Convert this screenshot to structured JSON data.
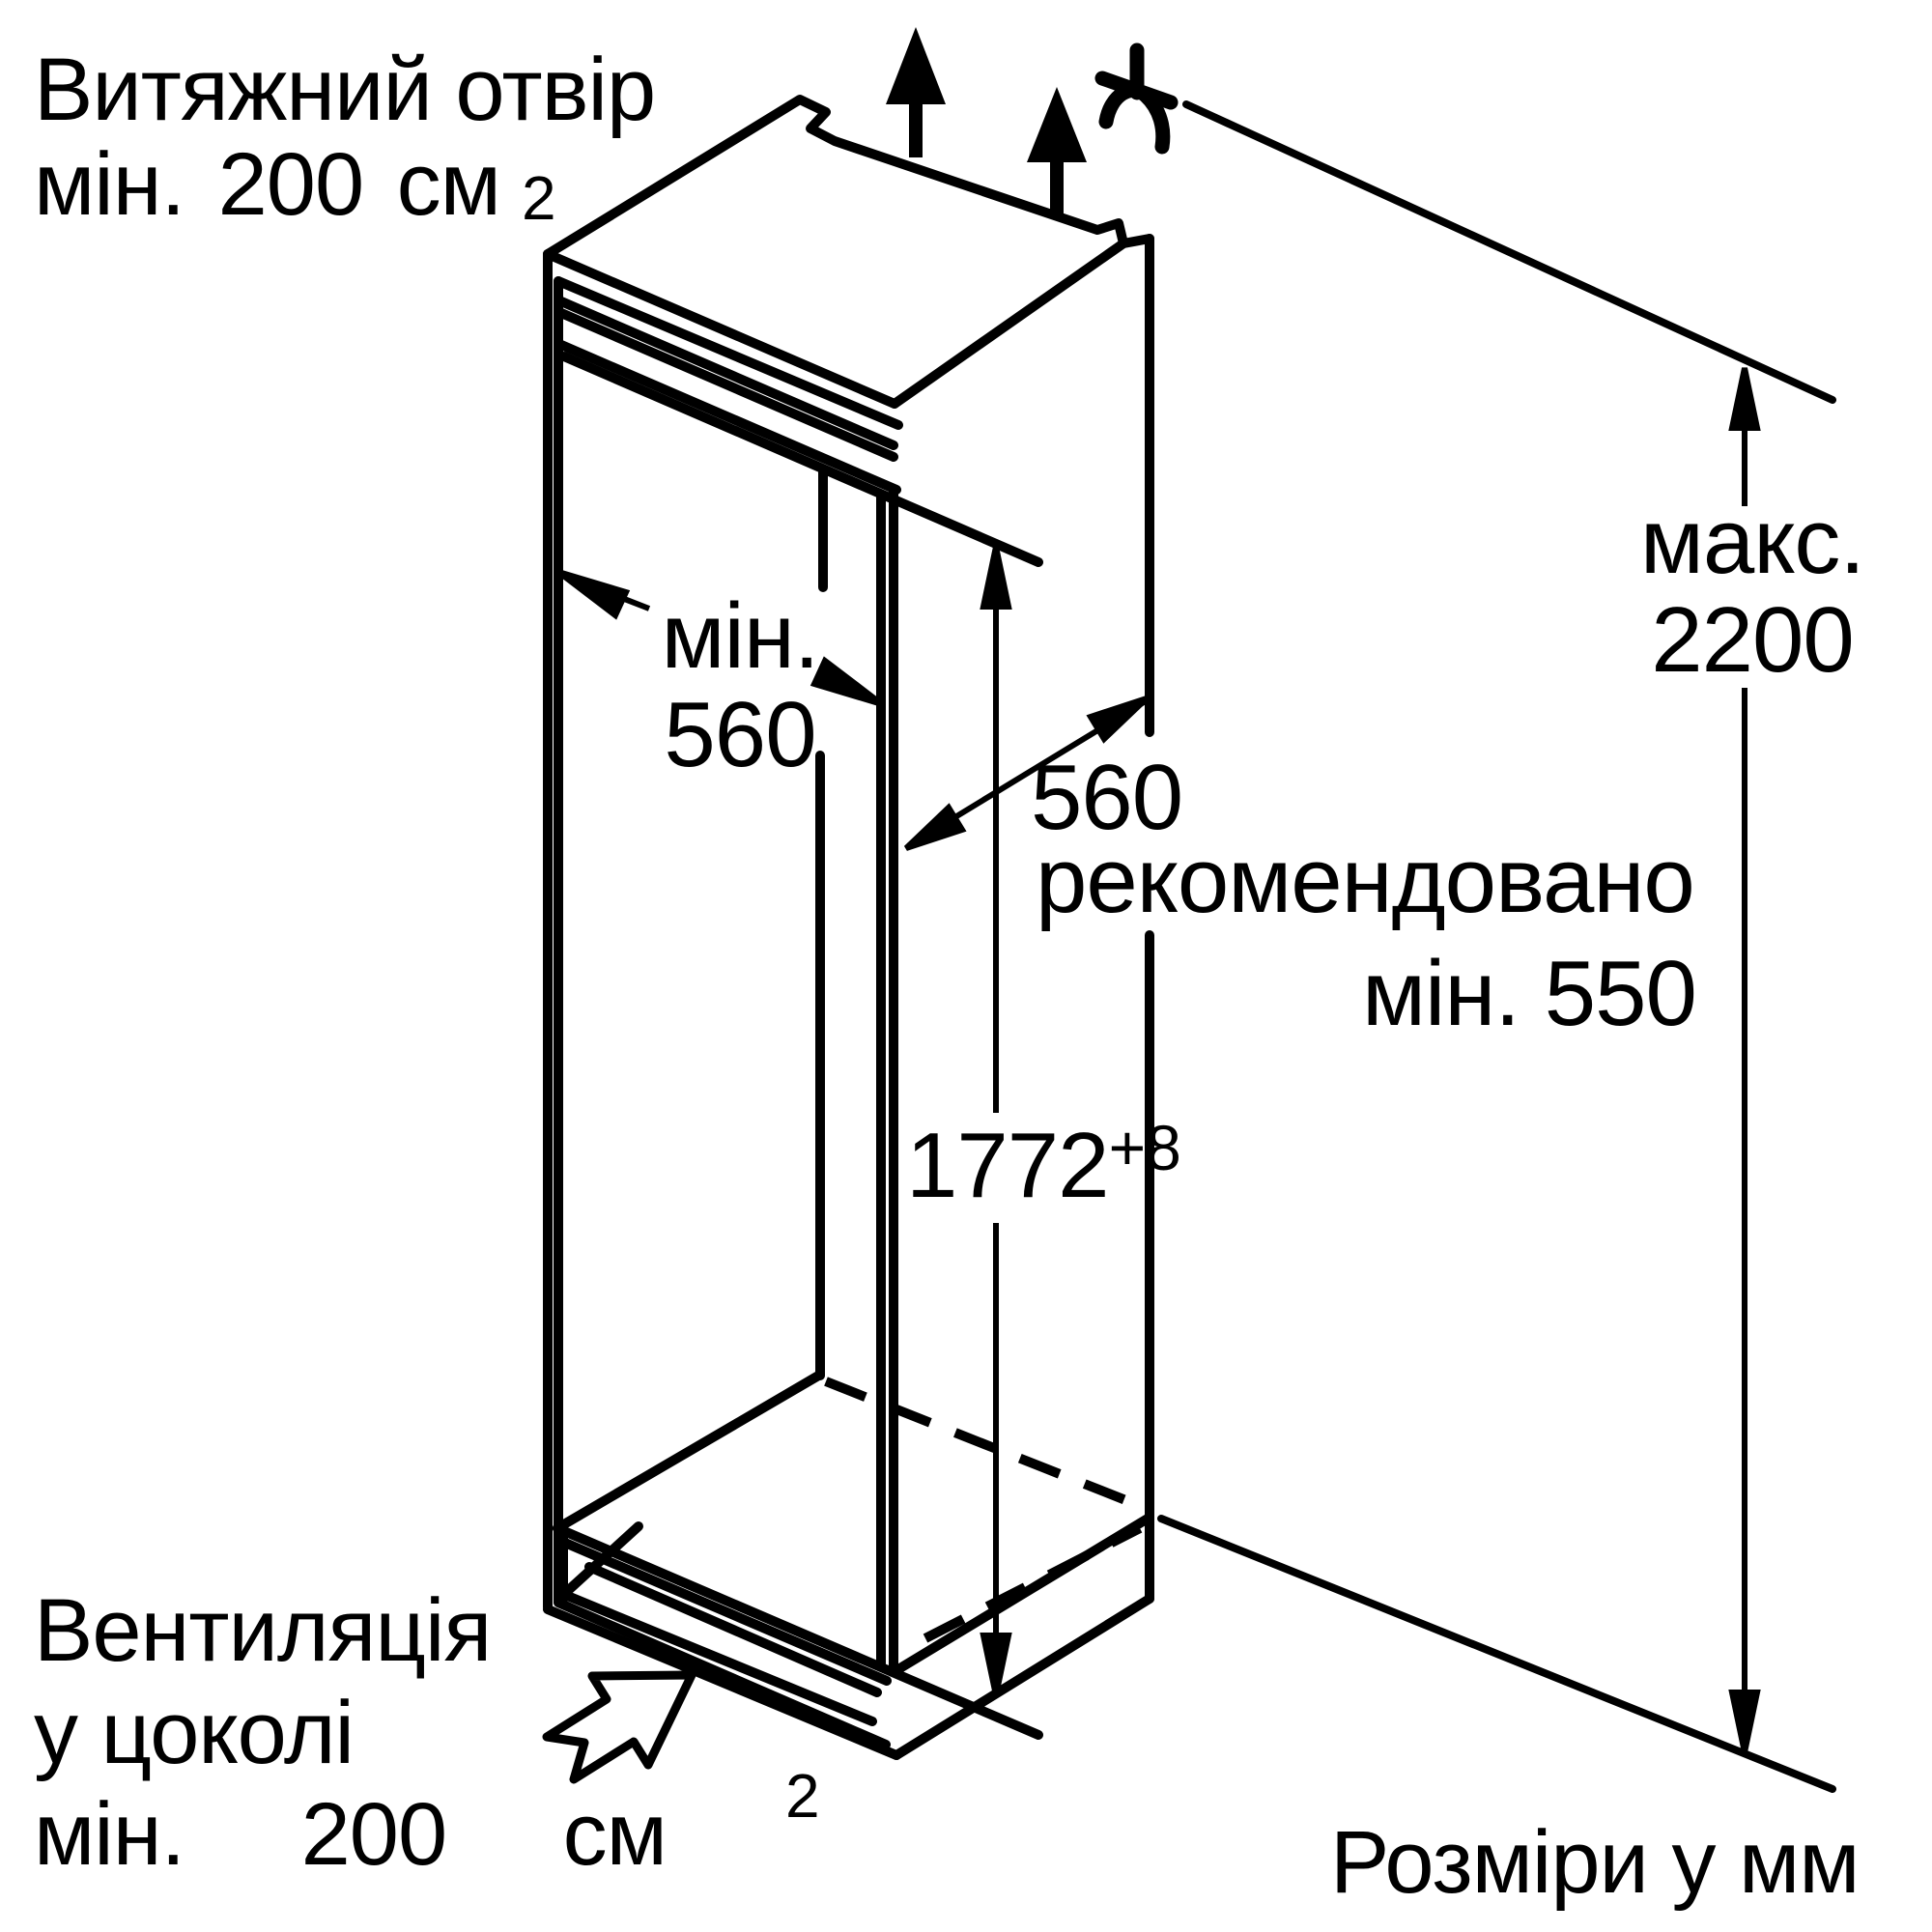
{
  "meta": {
    "type": "installation-dimension-diagram",
    "colors": {
      "ink": "#000000",
      "paper": "#ffffff"
    }
  },
  "labels": {
    "exhaust_top": {
      "line1": "Витяжний отвір",
      "line2": "мін. 200 см",
      "sup": "2"
    },
    "vent_bottom": {
      "line1": "Вентиляція",
      "line2": "у цоколі",
      "line3": "мін. 200 см",
      "sup": "2"
    },
    "units_note": "Розміри у мм"
  },
  "dimensions": {
    "niche_width": {
      "prefix": "мін.",
      "value": "560"
    },
    "niche_depth": {
      "value": "560",
      "note1": "рекомендовано",
      "note2": "мін. 550"
    },
    "niche_height": {
      "value": "1772",
      "tolerance": "+8"
    },
    "total_height": {
      "prefix": "макс.",
      "value": "2200"
    }
  },
  "icons": {
    "airflow": "thick-up-arrow",
    "power": "plug-with-cable",
    "base_vent": "hollow-up-right-arrow"
  }
}
